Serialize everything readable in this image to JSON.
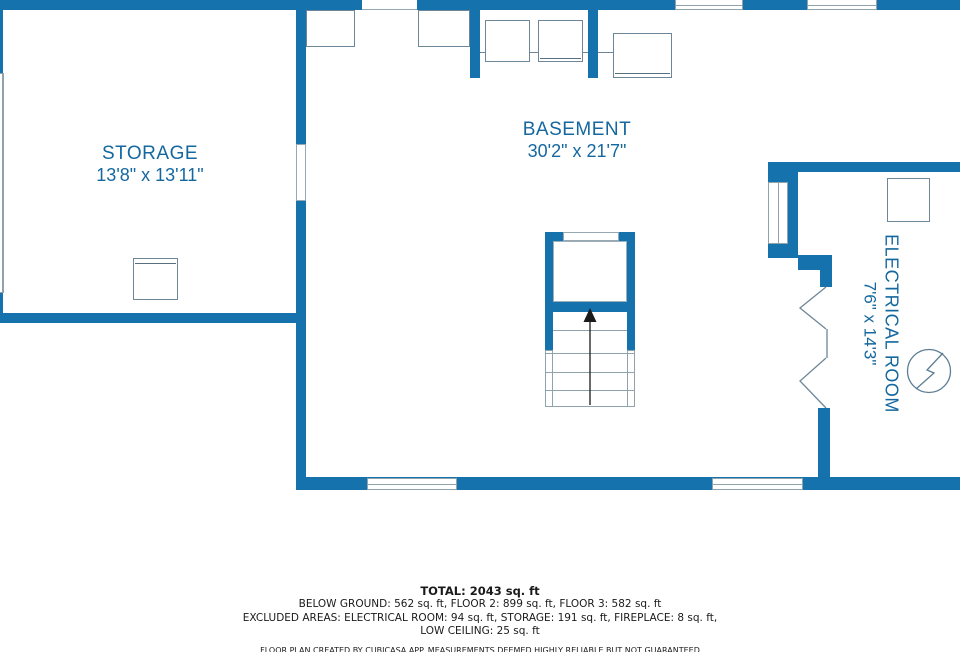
{
  "floor_plan": {
    "rooms": {
      "storage": {
        "name": "STORAGE",
        "dims": "13'8\" x 13'11\""
      },
      "basement": {
        "name": "BASEMENT",
        "dims": "30'2\" x 21'7\""
      },
      "electrical": {
        "name": "ELECTRICAL ROOM",
        "dims": "7'6\" x 14'3\""
      }
    },
    "summary": {
      "total": "TOTAL: 2043 sq. ft",
      "floors": "BELOW GROUND: 562 sq. ft, FLOOR 2: 899 sq. ft, FLOOR 3: 582 sq. ft",
      "excluded": "EXCLUDED AREAS: ELECTRICAL ROOM: 94 sq. ft, STORAGE: 191 sq. ft, FIREPLACE: 8 sq. ft,",
      "excluded2": "LOW CEILING: 25 sq. ft",
      "disclaimer": "FLOOR PLAN CREATED BY CUBICASA APP. MEASUREMENTS DEEMED HIGHLY RELIABLE BUT NOT GUARANTEED"
    },
    "colors": {
      "wall": "#1572AC",
      "label_text": "#15689F",
      "fixture_outline": "#6E8798",
      "window_line": "#8FA3AD",
      "arrow": "#1A1A1A"
    },
    "icons": {
      "electrical_symbol": "electrical-panel-icon",
      "stairs_direction": "up-arrow-icon"
    }
  }
}
